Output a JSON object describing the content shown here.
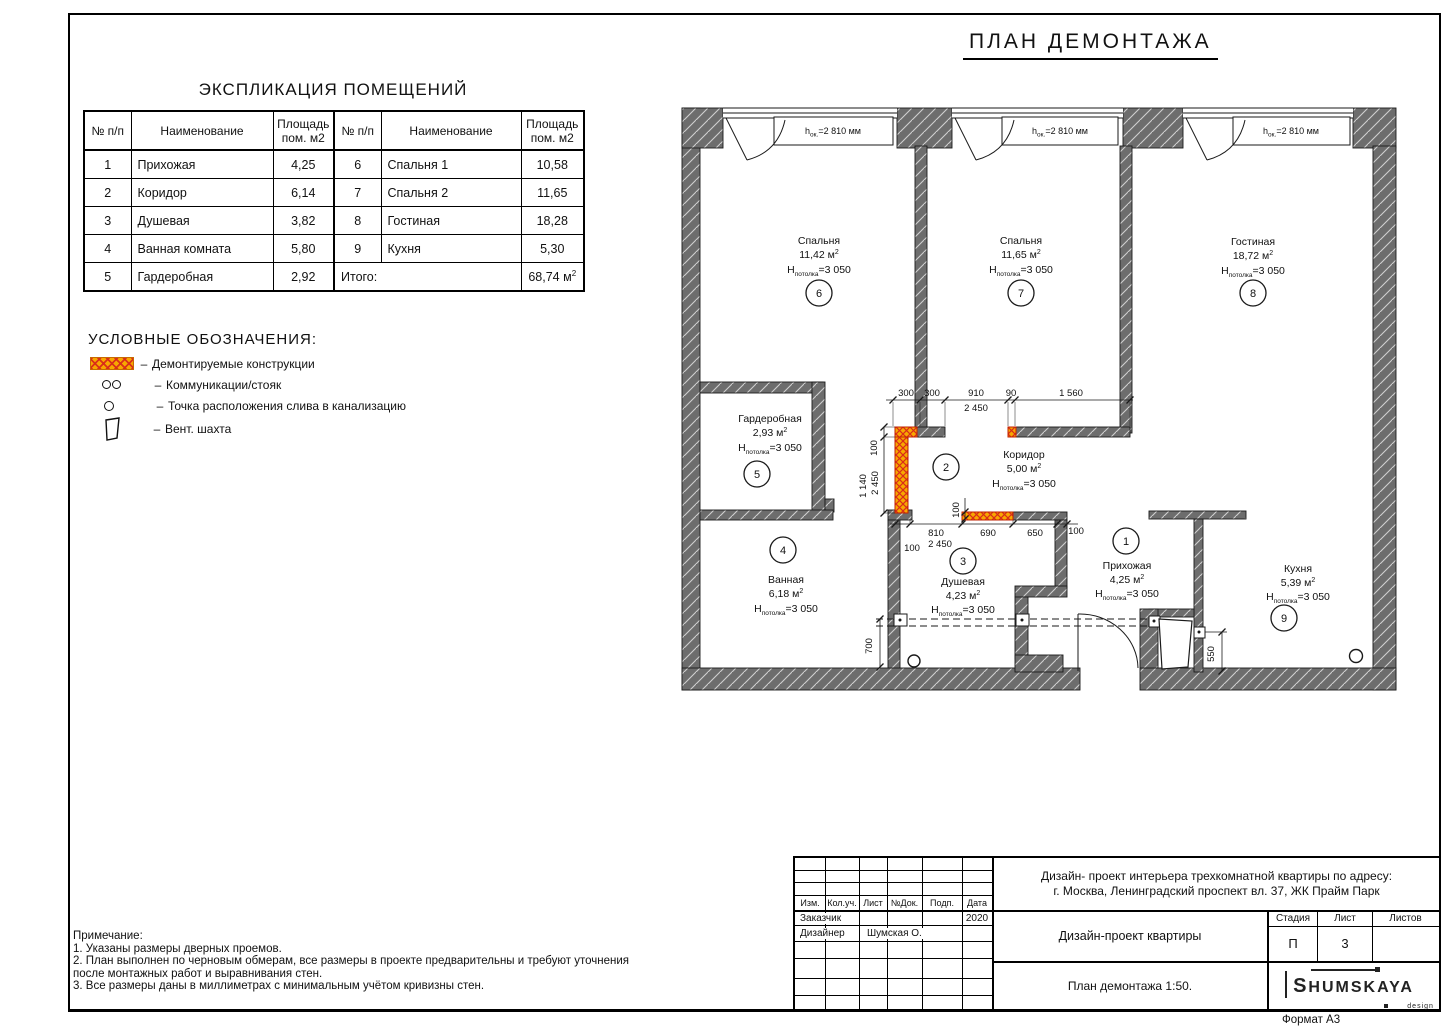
{
  "sheet": {
    "plan_title": "ПЛАН ДЕМОНТАЖА",
    "format_label": "Формат А3"
  },
  "explication": {
    "title": "ЭКСПЛИКАЦИЯ ПОМЕЩЕНИЙ",
    "col_headers": {
      "num": "№ п/п",
      "name": "Наименование",
      "area": "Площадь пом. м2"
    },
    "rows_left": [
      {
        "num": "1",
        "name": "Прихожая",
        "area": "4,25"
      },
      {
        "num": "2",
        "name": "Коридор",
        "area": "6,14"
      },
      {
        "num": "3",
        "name": "Душевая",
        "area": "3,82"
      },
      {
        "num": "4",
        "name": "Ванная комната",
        "area": "5,80"
      },
      {
        "num": "5",
        "name": "Гардеробная",
        "area": "2,92"
      }
    ],
    "rows_right": [
      {
        "num": "6",
        "name": "Спальня 1",
        "area": "10,58"
      },
      {
        "num": "7",
        "name": "Спальня 2",
        "area": "11,65"
      },
      {
        "num": "8",
        "name": "Гостиная",
        "area": "18,28"
      },
      {
        "num": "9",
        "name": "Кухня",
        "area": "5,30"
      }
    ],
    "total_label": "Итого:",
    "total_value": "68,74 м",
    "sup": "2"
  },
  "legend": {
    "title": "УСЛОВНЫЕ ОБОЗНАЧЕНИЯ:",
    "dash": "–",
    "items": [
      {
        "label": "Демонтируемые конструкции"
      },
      {
        "label": "Коммуникации/стояк"
      },
      {
        "label": "Точка расположения слива в канализацию"
      },
      {
        "label": "Вент. шахта"
      }
    ]
  },
  "plan": {
    "window": {
      "pre": "h",
      "sub": "ок.",
      "val": "=2 810 мм"
    },
    "ceil": {
      "pre": "H",
      "sub": "потолка",
      "val": "=3 050"
    },
    "sup2": "2",
    "rooms": [
      {
        "num": "1",
        "name": "Прихожая",
        "area": "4,25 м"
      },
      {
        "num": "2",
        "name": "Коридор",
        "area": "5,00 м"
      },
      {
        "num": "3",
        "name": "Душевая",
        "area": "4,23 м"
      },
      {
        "num": "4",
        "name": "Ванная",
        "area": "6,18 м"
      },
      {
        "num": "5",
        "name": "Гардеробная",
        "area": "2,93 м"
      },
      {
        "num": "6",
        "name": "Спальня",
        "area": "11,42 м"
      },
      {
        "num": "7",
        "name": "Спальня",
        "area": "11,65 м"
      },
      {
        "num": "8",
        "name": "Гостиная",
        "area": "18,72 м"
      },
      {
        "num": "9",
        "name": "Кухня",
        "area": "5,39 м"
      }
    ],
    "dims": {
      "top": [
        "300",
        "300",
        "910",
        "90",
        "1 560"
      ],
      "top_overall": "2 450",
      "left_col": [
        "100",
        "1 140",
        "2 450"
      ],
      "bottom": [
        "810",
        "690",
        "650",
        "100"
      ],
      "bottom_100": "100",
      "bottom_overall": "2 450",
      "red_100": "100",
      "bath": "700",
      "kitchen": "550"
    },
    "colors": {
      "wall": "#6d6d6d",
      "demolition_fill": "#f7a800",
      "demolition_cross": "#d92b1a"
    }
  },
  "notes": {
    "title": "Примечание:",
    "lines": [
      "1. Указаны размеры дверных проемов.",
      "2. План выполнен по черновым обмерам, все размеры в проекте предварительны и требуют уточнения",
      "после монтажных работ и выравнивания стен.",
      "3. Все размеры даны в миллиметрах с минимальным учётом кривизны стен."
    ]
  },
  "title_block": {
    "project_line1": "Дизайн- проект интерьера трехкомнатной квартиры по адресу:",
    "project_line2": "г. Москва, Ленинградский проспект вл. 37, ЖК Прайм Парк",
    "doc_title": "Дизайн-проект квартиры",
    "sheet_title": "План демонтажа 1:50.",
    "headers": {
      "izm": "Изм.",
      "koluch": "Кол.уч.",
      "list": "Лист",
      "ndok": "№Док.",
      "podp": "Подп.",
      "data": "Дата"
    },
    "customer_label": "Заказчик",
    "customer_year": "2020",
    "designer_label": "Дизайнер",
    "designer_name": "Шумская О.",
    "stage_label": "Стадия",
    "stage_value": "П",
    "sheet_label": "Лист",
    "sheet_value": "3",
    "sheets_label": "Листов",
    "sheets_value": "",
    "logo_text": "HUMSKAYA",
    "logo_first": "S",
    "logo_sub": "design"
  }
}
